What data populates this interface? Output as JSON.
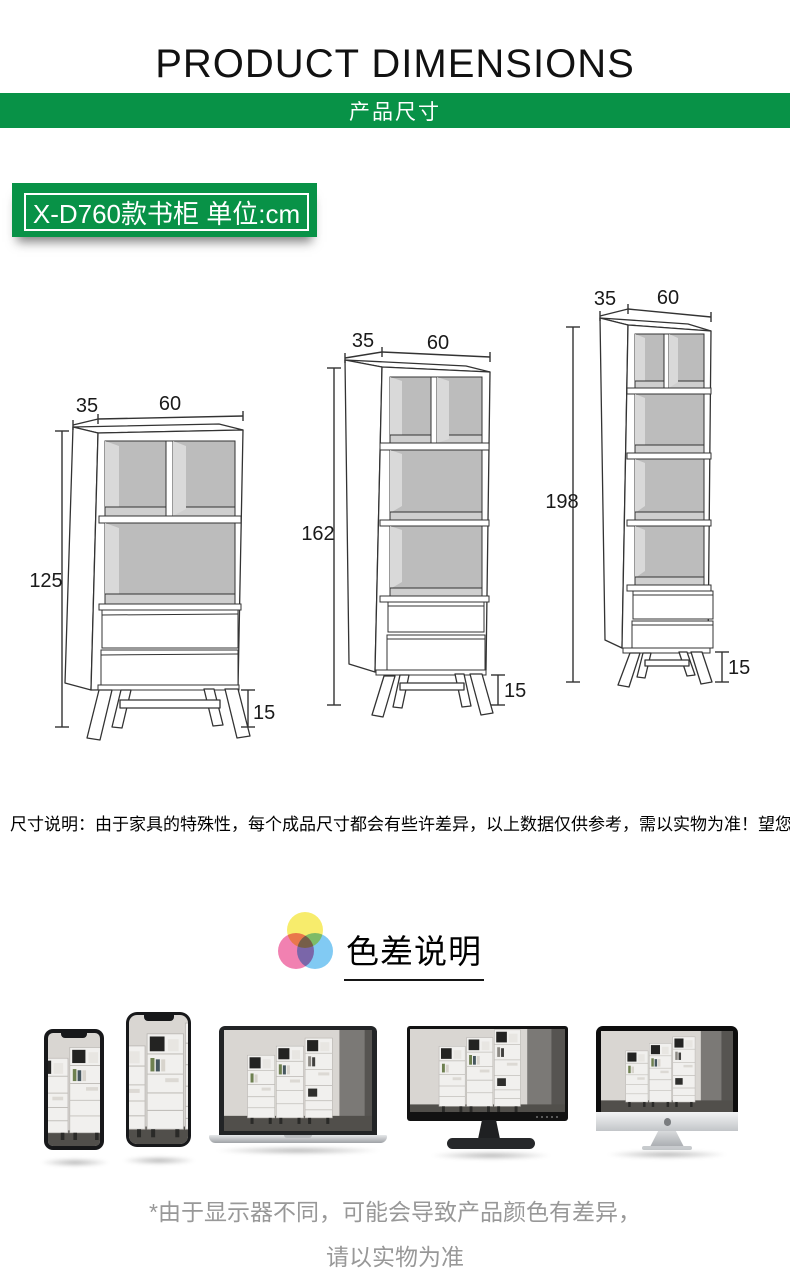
{
  "header": {
    "title": "PRODUCT DIMENSIONS",
    "banner": "产品尺寸"
  },
  "model_badge": {
    "label": "X-D760款书柜 单位:cm"
  },
  "cabinets": [
    {
      "id": "bookcase-125",
      "depth_cm": "35",
      "width_cm": "60",
      "height_cm": "125",
      "leg_height_cm": "15",
      "open_shelves": 1,
      "drawers": 2
    },
    {
      "id": "bookcase-162",
      "depth_cm": "35",
      "width_cm": "60",
      "height_cm": "162",
      "leg_height_cm": "15",
      "open_shelves": 2,
      "drawers": 2
    },
    {
      "id": "bookcase-198",
      "depth_cm": "35",
      "width_cm": "60",
      "height_cm": "198",
      "leg_height_cm": "15",
      "open_shelves": 3,
      "drawers": 2
    }
  ],
  "size_note": "尺寸说明：由于家具的特殊性，每个成品尺寸都会有些许差异，以上数据仅供参考，需以实物为准！望您理解！",
  "color_section": {
    "title": "色差说明",
    "footer_line1": "*由于显示器不同，可能会导致产品颜色有差异，",
    "footer_line2": "请以实物为准"
  },
  "devices": [
    "smartphone-small",
    "smartphone-large",
    "laptop",
    "desktop-monitor",
    "imac"
  ],
  "colors": {
    "brand_green": "#089247",
    "note_gray": "#989898",
    "venn_yellow": "#f6ea57",
    "venn_pink": "#f06fa6",
    "venn_blue": "#70c3f2",
    "line_dark": "#333333"
  }
}
